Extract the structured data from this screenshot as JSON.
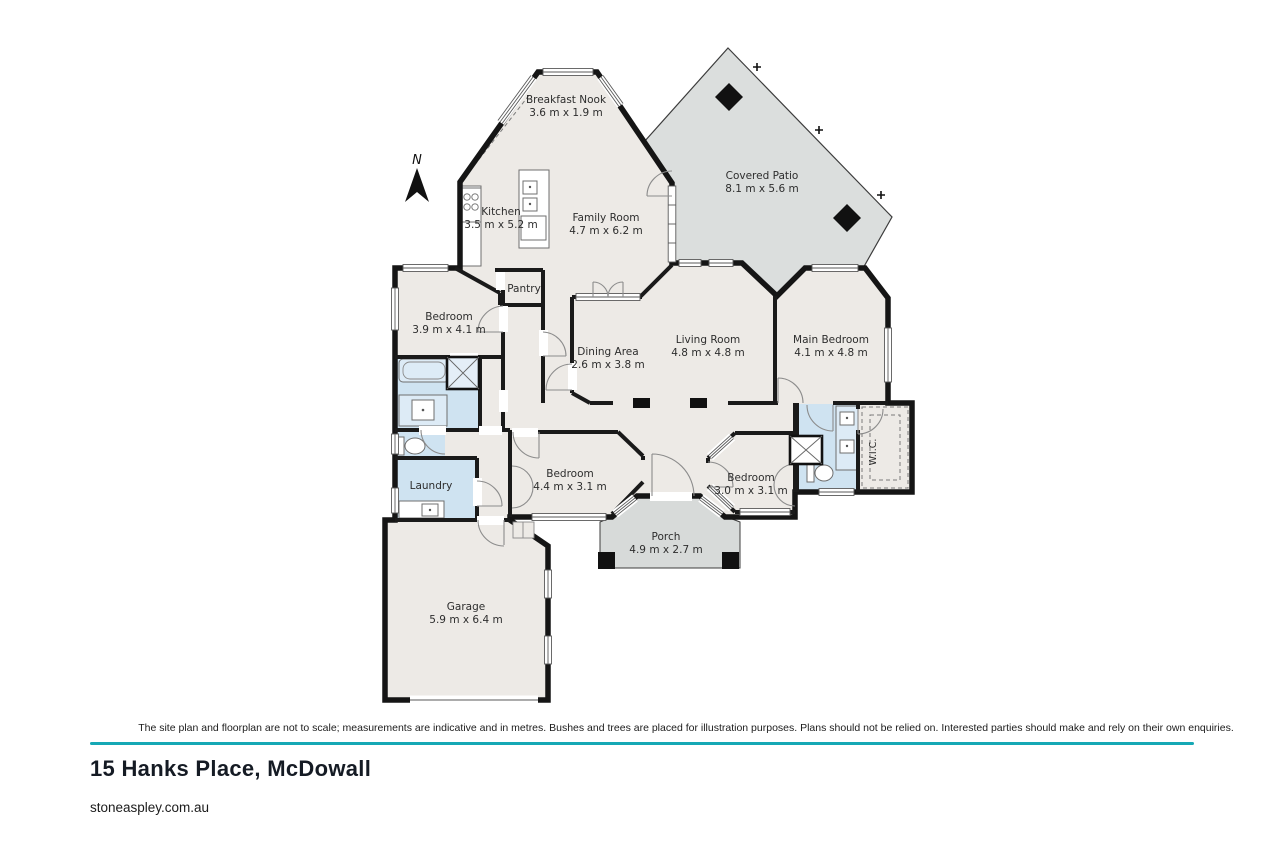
{
  "floorplan": {
    "north_label": "N",
    "rooms": [
      {
        "id": "breakfast-nook",
        "name": "Breakfast Nook",
        "dims": "3.6 m x 1.9 m"
      },
      {
        "id": "covered-patio",
        "name": "Covered Patio",
        "dims": "8.1 m x 5.6 m"
      },
      {
        "id": "kitchen",
        "name": "Kitchen",
        "dims": "3.5 m x 5.2 m"
      },
      {
        "id": "family-room",
        "name": "Family Room",
        "dims": "4.7 m x 6.2 m"
      },
      {
        "id": "pantry",
        "name": "Pantry",
        "dims": ""
      },
      {
        "id": "bedroom-left",
        "name": "Bedroom",
        "dims": "3.9 m x 4.1 m"
      },
      {
        "id": "dining-area",
        "name": "Dining Area",
        "dims": "2.6 m x 3.8 m"
      },
      {
        "id": "living-room",
        "name": "Living Room",
        "dims": "4.8 m x 4.8 m"
      },
      {
        "id": "main-bedroom",
        "name": "Main Bedroom",
        "dims": "4.1 m x 4.8 m"
      },
      {
        "id": "wic",
        "name": "W.I.C.",
        "dims": ""
      },
      {
        "id": "laundry",
        "name": "Laundry",
        "dims": ""
      },
      {
        "id": "bedroom-middle",
        "name": "Bedroom",
        "dims": "4.4 m x 3.1 m"
      },
      {
        "id": "bedroom-right",
        "name": "Bedroom",
        "dims": "3.0 m x 3.1 m"
      },
      {
        "id": "porch",
        "name": "Porch",
        "dims": "4.9 m x 2.7 m"
      },
      {
        "id": "garage",
        "name": "Garage",
        "dims": "5.9 m x 6.4 m"
      }
    ],
    "colors": {
      "floor": "#edeae6",
      "outdoor": "#dbdedd",
      "wet_area": "#cfe3f1",
      "wall": "#151515"
    }
  },
  "footer": {
    "disclaimer": "The site plan and floorplan are not to scale; measurements are indicative and in metres. Bushes and trees are placed for illustration purposes. Plans should not be relied on. Interested parties should make and rely on their own enquiries.",
    "address": "15 Hanks Place, McDowall",
    "website": "stoneaspley.com.au",
    "divider_color": "#16a8b5"
  }
}
